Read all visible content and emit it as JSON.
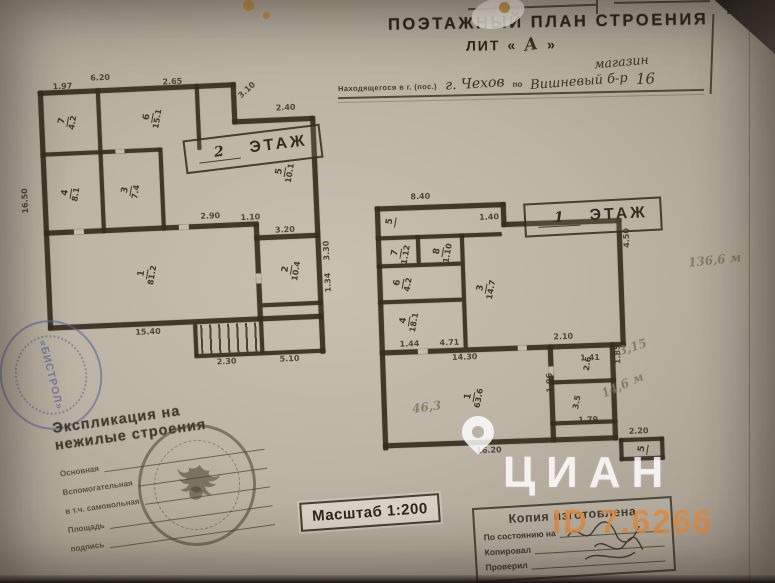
{
  "colors": {
    "paper": "#bdb4a5",
    "ink": "#382e1f",
    "stamp_ink": "#3c352a",
    "seal_blue": "#5a6898",
    "watermark_orange": "#de8c42",
    "watermark_white": "#ffffff"
  },
  "header": {
    "title": "ПОЭТАЖНЫЙ ПЛАН СТРОЕНИЯ",
    "lit_prefix": "ЛИТ",
    "lit_open": "«",
    "lit_value": "А",
    "lit_close": "»",
    "address_label": "Находящегося в г. (пос.)",
    "address_city": "г. Чехов",
    "address_po": "по",
    "address_overline": "магазин",
    "address_street": "Вишневый б-р",
    "address_house": "16"
  },
  "floor2": {
    "stamp_number": "2",
    "stamp_word": "ЭТАЖ",
    "dims": [
      {
        "text": "6.20",
        "x": 78,
        "y": 4
      },
      {
        "text": "1.97",
        "x": 40,
        "y": 11
      },
      {
        "text": "2.65",
        "x": 150,
        "y": 11
      },
      {
        "text": "3.10",
        "x": 224,
        "y": 30,
        "rot": -40
      },
      {
        "text": "2.40",
        "x": 262,
        "y": 42
      },
      {
        "text": "16.50",
        "x": 4,
        "y": 140,
        "rot": -90
      },
      {
        "text": "1.10",
        "x": 222,
        "y": 150
      },
      {
        "text": "2.90",
        "x": 182,
        "y": 147
      },
      {
        "text": "3.20",
        "x": 256,
        "y": 164
      },
      {
        "text": "3.30",
        "x": 303,
        "y": 200,
        "rot": -90
      },
      {
        "text": "1.34",
        "x": 303,
        "y": 232,
        "rot": -90
      },
      {
        "text": "15.40",
        "x": 112,
        "y": 260
      },
      {
        "text": "2.30",
        "x": 192,
        "y": 293
      },
      {
        "text": "5.10",
        "x": 255,
        "y": 293
      }
    ],
    "rooms": [
      {
        "n": "7",
        "a": "4.2",
        "x": 46,
        "y": 40
      },
      {
        "n": "6",
        "a": "15.1",
        "x": 128,
        "y": 40
      },
      {
        "n": "5",
        "a": "10.1",
        "x": 258,
        "y": 100
      },
      {
        "n": "4",
        "a": "8.1",
        "x": 46,
        "y": 112
      },
      {
        "n": "3",
        "a": "7.4",
        "x": 106,
        "y": 112
      },
      {
        "n": "2",
        "a": "10.4",
        "x": 260,
        "y": 198
      },
      {
        "n": "1",
        "a": "81.2",
        "x": 116,
        "y": 196
      }
    ]
  },
  "floor1": {
    "stamp_number": "1",
    "stamp_word": "ЭТАЖ",
    "dims": [
      {
        "text": "8.40",
        "x": 48,
        "y": 10
      },
      {
        "text": "1.40",
        "x": 116,
        "y": 33
      },
      {
        "text": "4.50",
        "x": 259,
        "y": 72,
        "rot": -90
      },
      {
        "text": "2.10",
        "x": 186,
        "y": 155
      },
      {
        "text": "1.44",
        "x": 32,
        "y": 157
      },
      {
        "text": "4.71",
        "x": 72,
        "y": 157
      },
      {
        "text": "14.30",
        "x": 84,
        "y": 172
      },
      {
        "text": "1.41",
        "x": 212,
        "y": 177
      },
      {
        "text": "1.85",
        "x": 246,
        "y": 188,
        "rot": -90
      },
      {
        "text": "1.96",
        "x": 177,
        "y": 214,
        "rot": -90
      },
      {
        "text": "1.79",
        "x": 208,
        "y": 239
      },
      {
        "text": "16.20",
        "x": 105,
        "y": 266
      },
      {
        "text": "2.20",
        "x": 258,
        "y": 252
      }
    ],
    "rooms": [
      {
        "n": "5",
        "a": "",
        "x": 22,
        "y": 32
      },
      {
        "n": "7",
        "a": "1.12",
        "x": 26,
        "y": 60
      },
      {
        "n": "8",
        "a": "1.10",
        "x": 68,
        "y": 60
      },
      {
        "n": "6",
        "a": "4.2",
        "x": 30,
        "y": 90
      },
      {
        "n": "3",
        "a": "14.7",
        "x": 110,
        "y": 98
      },
      {
        "n": "4",
        "a": "18.1",
        "x": 32,
        "y": 128
      },
      {
        "n": "1",
        "a": "63.6",
        "x": 94,
        "y": 206
      },
      {
        "n": "",
        "a": "2.6",
        "x": 212,
        "y": 182
      },
      {
        "n": "",
        "a": "3.5",
        "x": 200,
        "y": 220
      },
      {
        "n": "5",
        "a": "",
        "x": 266,
        "y": 268
      }
    ]
  },
  "pencil_notes": [
    {
      "text": "136,6 м",
      "x": 688,
      "y": 253,
      "rot": -6
    },
    {
      "text": "3,15",
      "x": 618,
      "y": 340,
      "rot": -18
    },
    {
      "text": "14,6 м",
      "x": 600,
      "y": 378,
      "rot": -24
    },
    {
      "text": "46,3",
      "x": 412,
      "y": 400,
      "rot": -8
    }
  ],
  "stamps": {
    "explication": {
      "title1": "Экспликация на",
      "title2": "нежилые строения",
      "rows": [
        "Основная",
        "Вспомогательная",
        "в т.ч. самовольная",
        "Площадь",
        "подпись"
      ]
    },
    "scale": {
      "label": "Масштаб 1:200"
    },
    "copy": {
      "title": "Копия изготовлена",
      "rows": [
        "По состоянию на",
        "Копировал",
        "Проверил"
      ]
    },
    "seal_text": "«БИСТРОЛ»"
  },
  "watermark": {
    "brand": "ЦИАН",
    "id_text": "ID 7.6266"
  }
}
